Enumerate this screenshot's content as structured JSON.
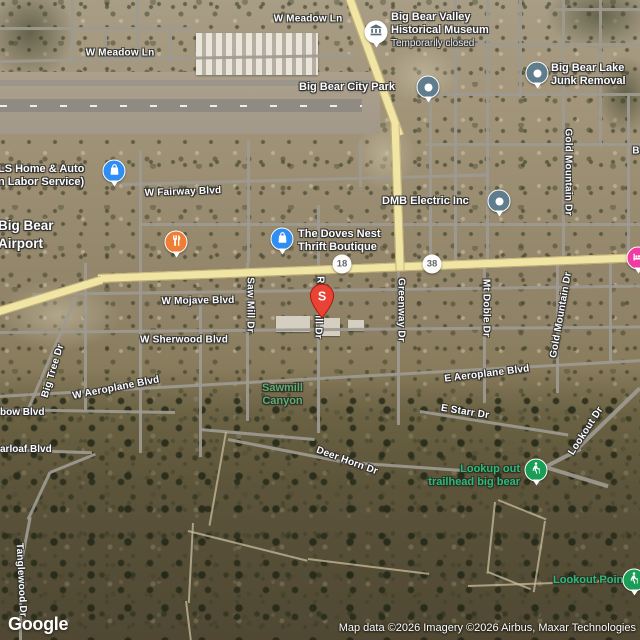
{
  "attribution": {
    "logo": "Google",
    "copyright": "Map data ©2026 Imagery ©2026 Airbus, Maxar Technologies"
  },
  "marker": {
    "label": "S"
  },
  "shields": {
    "hwy18": "18",
    "hwy38": "38"
  },
  "pois": {
    "museum": {
      "line1": "Big Bear Valley",
      "line2": "Historical Museum",
      "status": "Temporarily closed",
      "icon": "museum-icon"
    },
    "city_park": {
      "line1": "Big Bear City Park",
      "icon": "place-pin"
    },
    "junk_removal": {
      "line1": "Big Bear Lake",
      "line2": "Junk Removal",
      "icon": "place-pin"
    },
    "dmb_electric": {
      "line1": "DMB Electric Inc",
      "icon": "place-pin"
    },
    "ls_home_auto": {
      "line1": "LS Home & Auto",
      "line2": "n Labor Service)",
      "icon": "shopping-bag-icon"
    },
    "airport": {
      "line1": "Big Bear",
      "line2": "Airport"
    },
    "doves_nest": {
      "line1": "The Doves Nest",
      "line2": "Thrift Boutique",
      "icon": "shopping-bag-icon"
    },
    "restaurant_pin": {
      "icon": "restaurant-icon"
    },
    "lodging_pin": {
      "icon": "bed-icon"
    },
    "trailhead": {
      "line1": "Lookup out",
      "line2": "trailhead big bear",
      "icon": "hiking-icon"
    },
    "lookout_point": {
      "line1": "Lookout Point",
      "icon": "hiking-icon"
    },
    "sawmill_canyon": {
      "line1": "Sawmill",
      "line2": "Canyon"
    }
  },
  "streets": {
    "meadow_w": "W Meadow Ln",
    "meadow_e": "W Meadow Ln",
    "fairway": "W Fairway Blvd",
    "mojave": "W Mojave Blvd",
    "sherwood": "W Sherwood Blvd",
    "w_aeroplane": "W Aeroplane Blvd",
    "e_aeroplane": "E Aeroplane Blvd",
    "e_starr": "E Starr Dr",
    "deer_horn": "Deer Horn Dr",
    "rainbow_partial": "bow Blvd",
    "sugarloaf_partial": "arloaf Blvd",
    "big_tree": "Big Tree Dr",
    "saw_mill": "Saw Mill Dr",
    "ro_partial": "Ro",
    "ill_dr_partial": "ill Dr",
    "greenway": "Greenway Dr",
    "mt_doble": "Mt Doble Dr",
    "gold_mountain_n": "Gold Mountain Dr",
    "gold_mountain_s": "Gold Mountain Dr",
    "lookout": "Lookout Dr",
    "tanglewood": "Tanglewood Dr",
    "b_partial": "B"
  },
  "colors": {
    "marker_red": "#EA4335",
    "place_slate": "#5f7d8c",
    "shopping_blue": "#2f8ef5",
    "restaurant_orange": "#ef7d36",
    "poi_green": "#1a9e55",
    "lodging_pink": "#f13ba2",
    "highway_yellow": "#f1e5a6",
    "park_label_green": "#5fae69",
    "green_poi_label": "#2dbd6e"
  }
}
